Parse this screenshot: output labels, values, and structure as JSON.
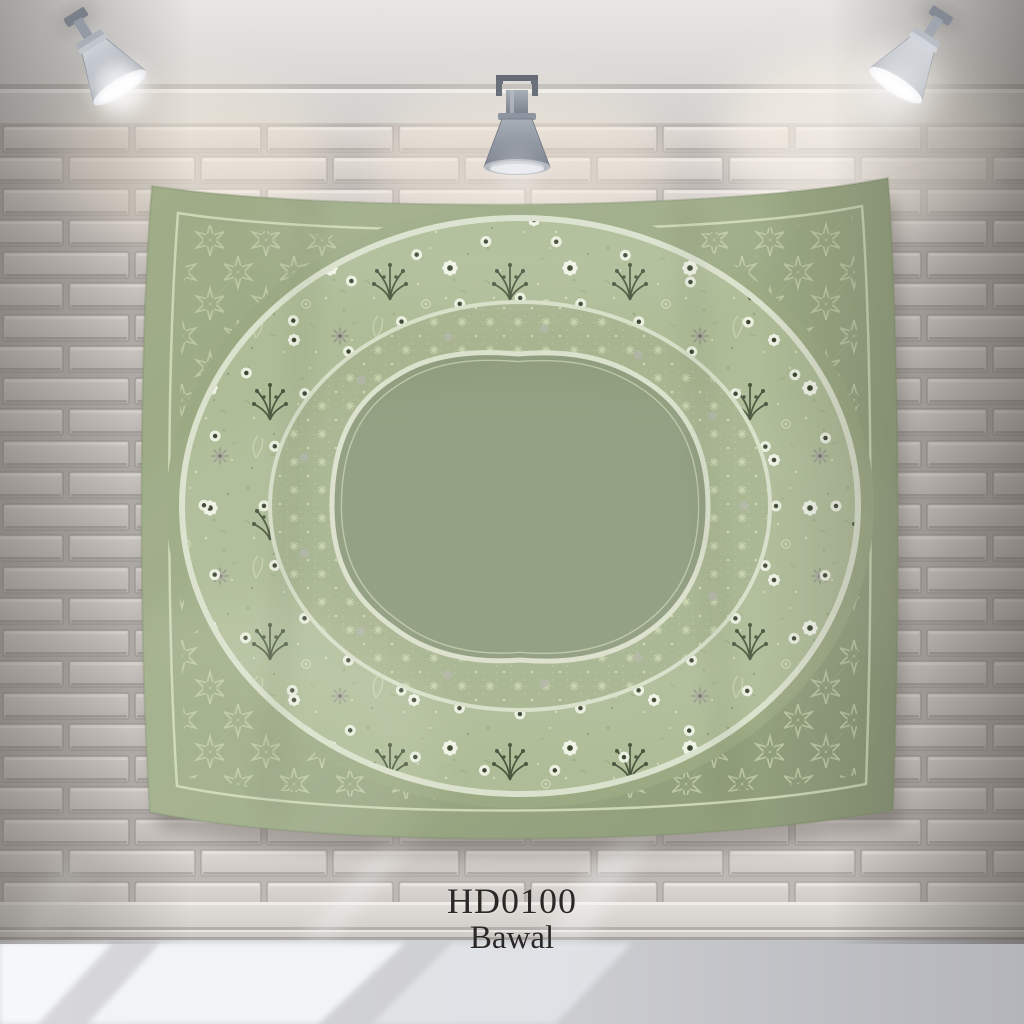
{
  "product": {
    "code": "HD0100",
    "name": "Bawal"
  },
  "scene": {
    "lamps": [
      "spotlight-left",
      "spotlight-center",
      "spotlight-right"
    ],
    "colors": {
      "scarf_base": "#9cab85",
      "scarf_center": "#8f9c7d",
      "scarf_lattice_line": "#bdc9a5",
      "wreath_floral_bg": "#aebc97",
      "floral_dark_green": "#4a573e",
      "floral_white": "#eff3e5",
      "floral_gray": "#a9ab9a",
      "ring_outline_cream": "#dae1cc",
      "brick_face": "#d8d3cf",
      "mortar": "#bdb8b4",
      "baseboard": "#d9d5d1",
      "floor": "#cfcfd3",
      "label_text": "#2b2927"
    }
  }
}
